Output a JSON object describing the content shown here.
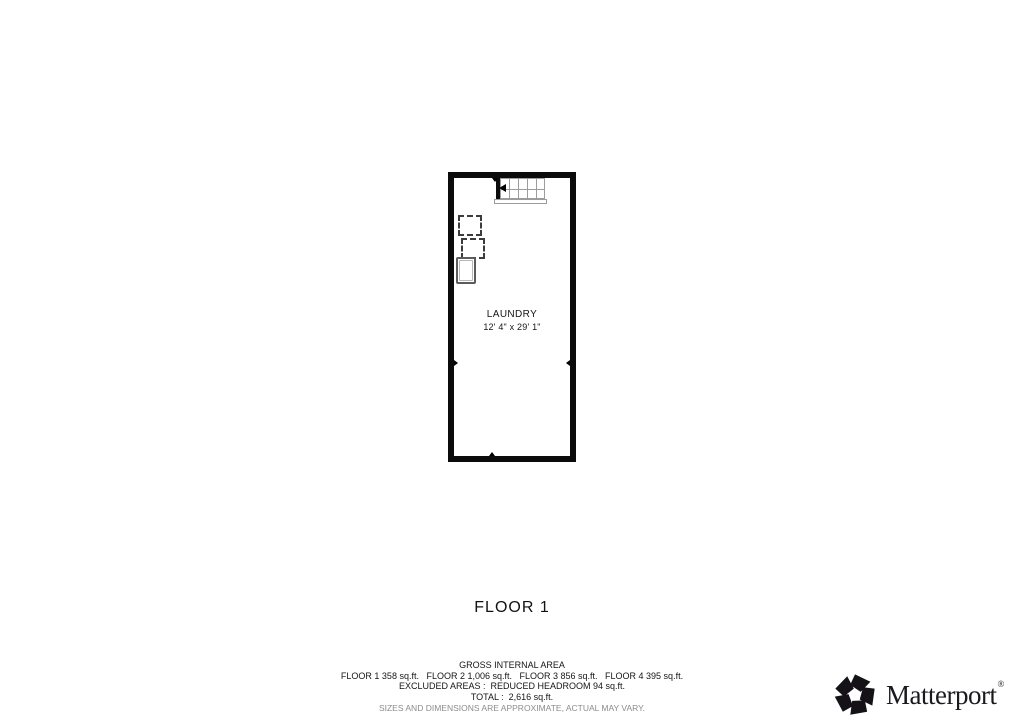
{
  "floor_plan": {
    "room": {
      "label": "LAUNDRY",
      "dimensions": "12' 4\" x 29' 1\"",
      "wall_color": "#0b0b0b"
    },
    "icons": {
      "staircase": "stair-treads-with-up-direction-arrow",
      "appliances": "two-dashed-square-outlines",
      "fixture": "double-outline-rectangle",
      "wall_ticks": "small-black-triangle-markers"
    },
    "stair_color": "#9c9c9c"
  },
  "title": {
    "label": "FLOOR 1"
  },
  "footer": {
    "heading": "GROSS INTERNAL AREA",
    "floor_areas": "FLOOR 1 358 sq.ft.   FLOOR 2 1,006 sq.ft.   FLOOR 3 856 sq.ft.   FLOOR 4 395 sq.ft.",
    "excluded": "EXCLUDED AREAS :  REDUCED HEADROOM 94 sq.ft.",
    "total": "TOTAL :  2,616 sq.ft.",
    "disclaimer": "SIZES AND DIMENSIONS ARE APPROXIMATE, ACTUAL MAY VARY.",
    "disclaimer_color": "#8c8c8c"
  },
  "branding": {
    "logo_text": "Matterport",
    "registered_mark": "®",
    "logo_color": "#1b191e"
  }
}
